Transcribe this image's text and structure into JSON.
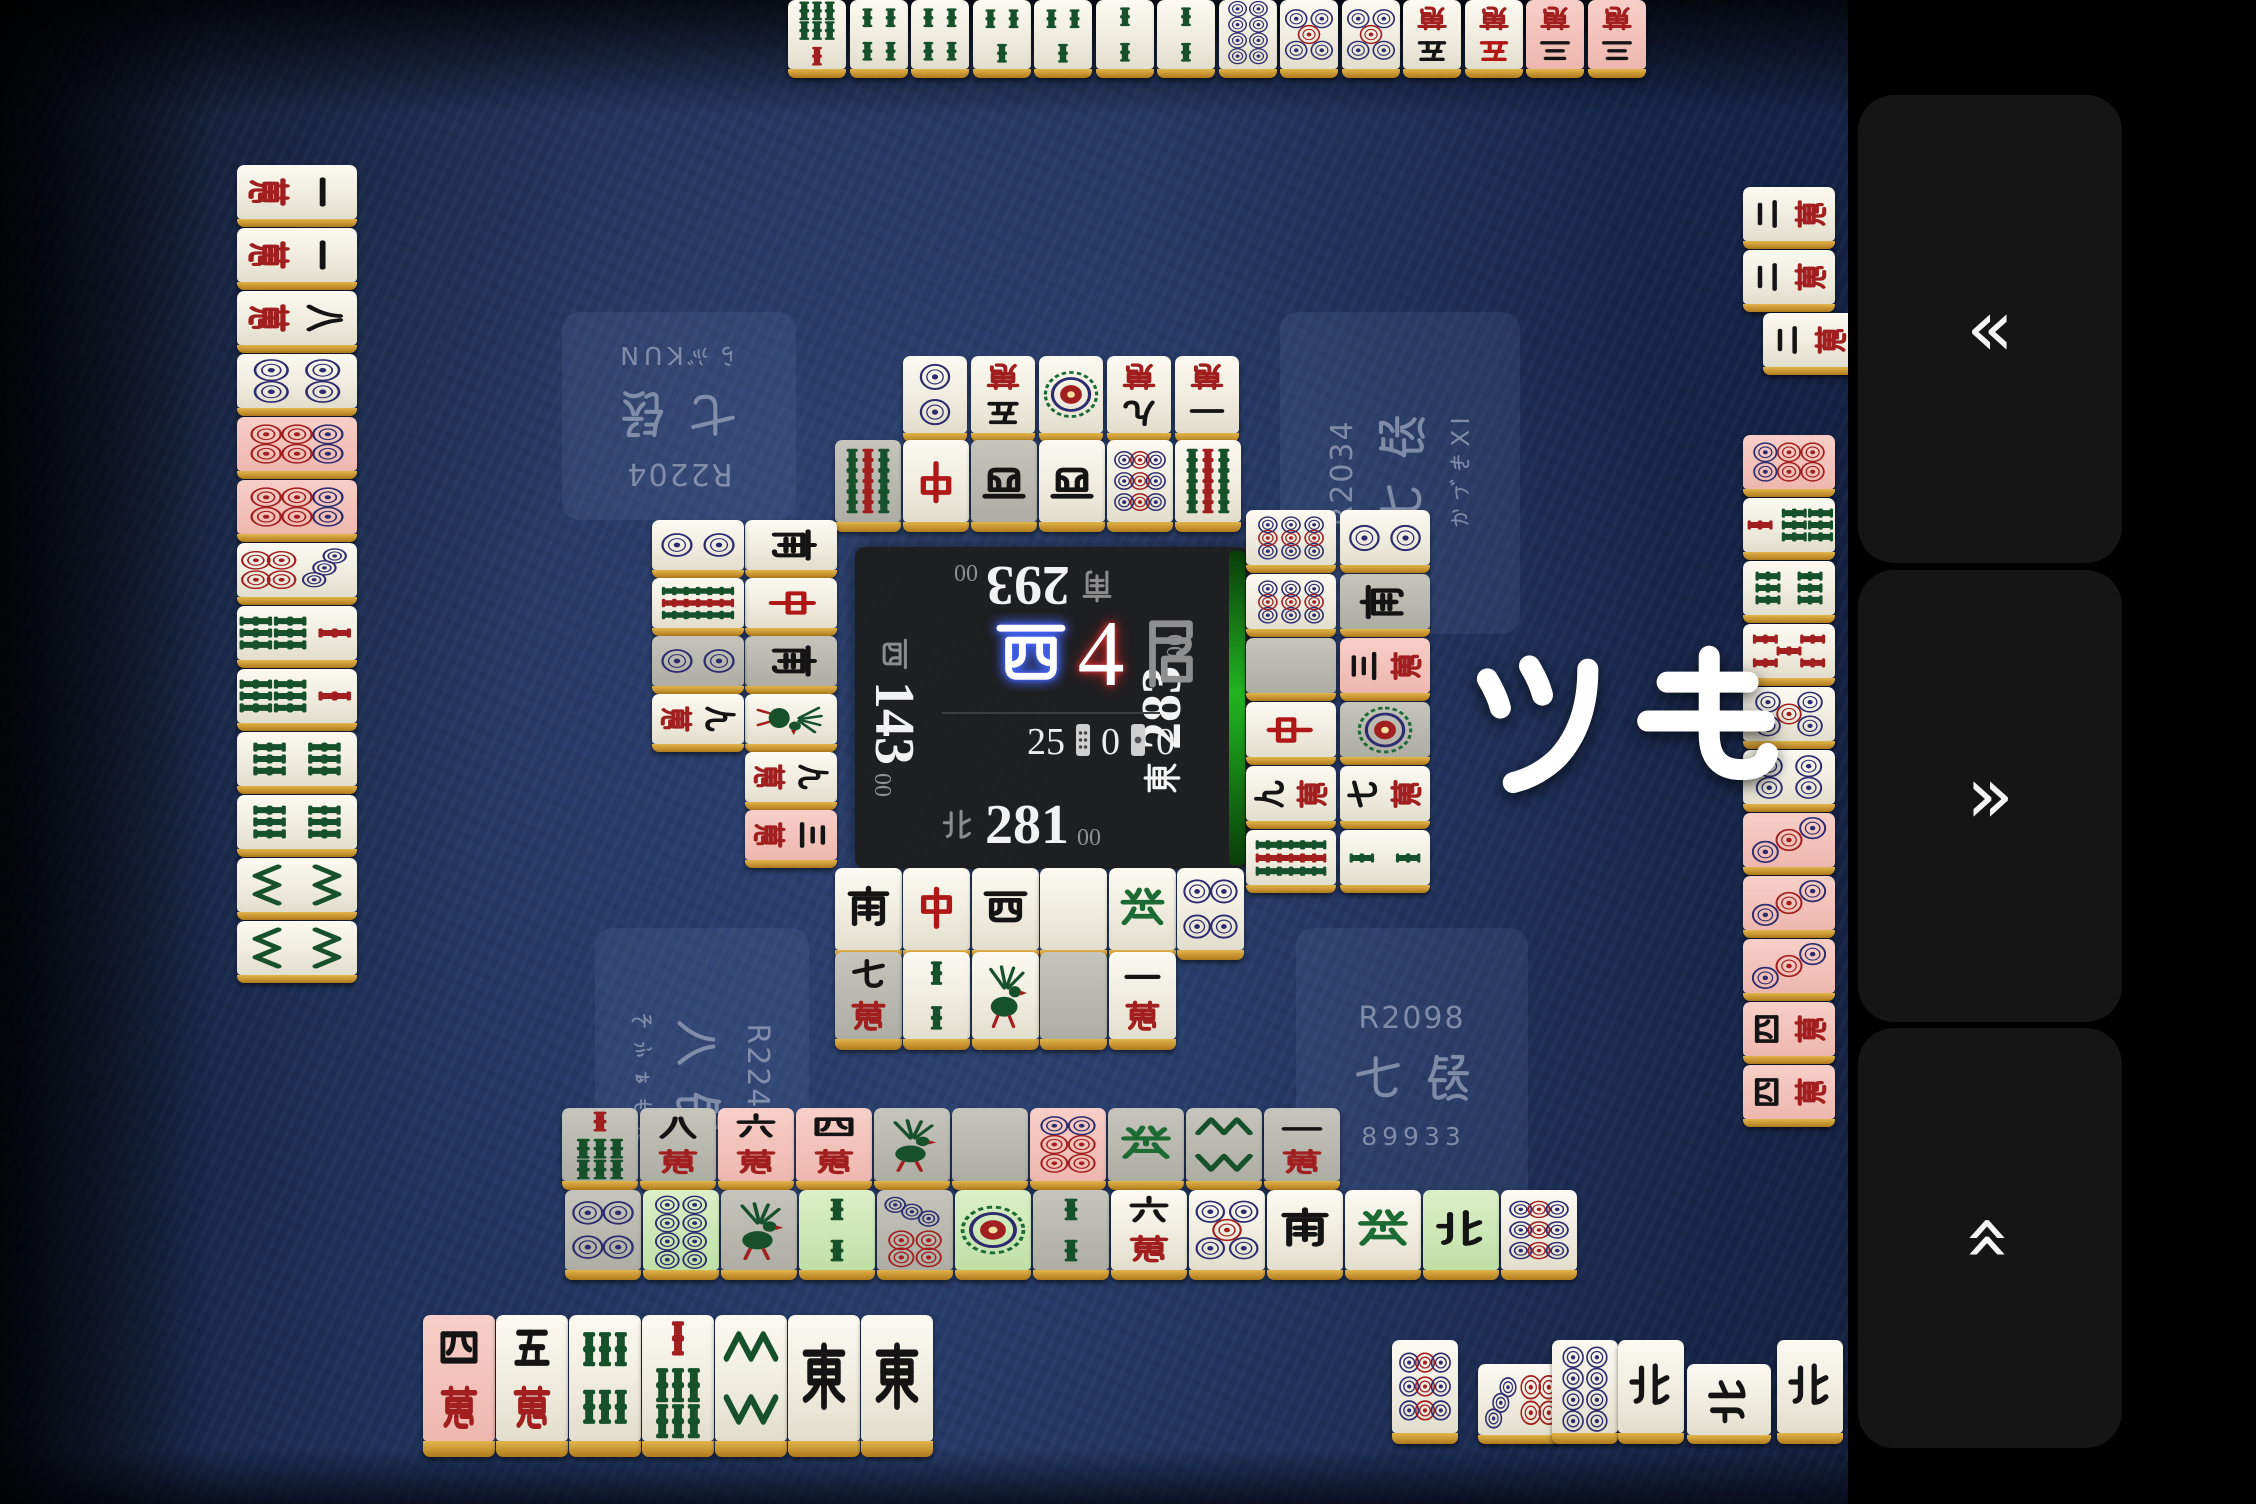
{
  "app": {
    "accent_green": "#1fae1f",
    "table_color": "#1b2a4e"
  },
  "announcement": {
    "text": "ツモ"
  },
  "sidebar": {
    "buttons": [
      {
        "name": "rewind-button",
        "glyph": "«",
        "rotate": 0,
        "x": 10,
        "y": 95,
        "w": 264,
        "h": 468
      },
      {
        "name": "forward-button",
        "glyph": "»",
        "rotate": 0,
        "x": 10,
        "y": 570,
        "w": 264,
        "h": 452
      },
      {
        "name": "collapse-button",
        "glyph": "«",
        "rotate": 90,
        "x": 10,
        "y": 1028,
        "w": 264,
        "h": 420
      }
    ]
  },
  "center": {
    "round": {
      "wind": "西",
      "number": "4",
      "suffix": "局"
    },
    "counters": {
      "tiles_left": "25",
      "honba": "0",
      "riichi_sticks": "0"
    },
    "turn_indicator": "east",
    "seats": {
      "top": {
        "wind": "南",
        "score": "293",
        "sub": "00"
      },
      "left": {
        "wind": "西",
        "score": "143",
        "sub": "00"
      },
      "right": {
        "wind": "東",
        "score": "283",
        "sub": "00"
      },
      "bottom": {
        "wind": "北",
        "score": "281",
        "sub": "00"
      }
    }
  },
  "players": {
    "top_left": {
      "rating": "R2204",
      "rank": "七段",
      "name": "らぶKUN",
      "rotate": 180,
      "x": 562,
      "y": 312,
      "w": 234,
      "h": 208
    },
    "top_right": {
      "rating": "R2034",
      "rank": "七段",
      "name": "かづきXI",
      "rotate": -90,
      "x": 1280,
      "y": 312,
      "w": 240,
      "h": 322
    },
    "bottom_left": {
      "rating": "R2240",
      "rank": "八段",
      "name": "そふぁもん",
      "rotate": 90,
      "x": 595,
      "y": 928,
      "w": 214,
      "h": 298
    },
    "bottom_right": {
      "rating": "R2098",
      "rank": "七段",
      "name": "89933",
      "rotate": 0,
      "x": 1296,
      "y": 928,
      "w": 232,
      "h": 296
    }
  },
  "zones": [
    {
      "name": "top-hand",
      "rot": 180,
      "axis": "x",
      "fixed": 0,
      "w": 58,
      "h": 78,
      "interactable": false,
      "tiles": [
        [
          788,
          "7s"
        ],
        [
          850,
          "4s"
        ],
        [
          911,
          "4s"
        ],
        [
          973,
          "3s"
        ],
        [
          1034,
          "3s"
        ],
        [
          1096,
          "2s"
        ],
        [
          1157,
          "2s"
        ],
        [
          1219,
          "8p"
        ],
        [
          1280,
          "5p"
        ],
        [
          1342,
          "5p"
        ],
        [
          1403,
          "5m"
        ],
        [
          1465,
          "5m",
          "red5"
        ],
        [
          1526,
          "3m",
          "pink"
        ],
        [
          1588,
          "3m",
          "pink"
        ]
      ]
    },
    {
      "name": "top-river-row2",
      "rot": 180,
      "axis": "x",
      "fixed": 356,
      "w": 64,
      "h": 86,
      "interactable": false,
      "tiles": [
        [
          903,
          "2p"
        ],
        [
          971,
          "5m"
        ],
        [
          1039,
          "1p"
        ],
        [
          1107,
          "9m"
        ],
        [
          1175,
          "1m"
        ]
      ]
    },
    {
      "name": "top-river-row1",
      "rot": 180,
      "axis": "x",
      "fixed": 440,
      "w": 66,
      "h": 92,
      "interactable": false,
      "tiles": [
        [
          835,
          "9s",
          "gray"
        ],
        [
          903,
          "C"
        ],
        [
          971,
          "W",
          "gray"
        ],
        [
          1039,
          "W"
        ],
        [
          1107,
          "9p"
        ],
        [
          1175,
          "9s"
        ]
      ]
    },
    {
      "name": "left-hand",
      "rot": 90,
      "axis": "y",
      "fixed": 237,
      "w": 120,
      "h": 62,
      "interactable": false,
      "tiles": [
        [
          165,
          "1m"
        ],
        [
          228,
          "1m"
        ],
        [
          291,
          "8m"
        ],
        [
          354,
          "4p"
        ],
        [
          417,
          "6p",
          "pink"
        ],
        [
          480,
          "6p",
          "pink"
        ],
        [
          543,
          "7p"
        ],
        [
          606,
          "7s"
        ],
        [
          669,
          "7s"
        ],
        [
          732,
          "6s"
        ],
        [
          795,
          "6s"
        ],
        [
          858,
          "8s"
        ],
        [
          921,
          "8s"
        ]
      ]
    },
    {
      "name": "left-river-col1",
      "rot": 90,
      "axis": "y",
      "fixed": 745,
      "w": 92,
      "h": 58,
      "interactable": false,
      "tiles": [
        [
          520,
          "S"
        ],
        [
          578,
          "C"
        ],
        [
          636,
          "S",
          "gray"
        ],
        [
          694,
          "1s"
        ],
        [
          752,
          "9m"
        ],
        [
          810,
          "3m",
          "pink"
        ]
      ]
    },
    {
      "name": "left-river-col2",
      "rot": 90,
      "axis": "y",
      "fixed": 652,
      "w": 92,
      "h": 58,
      "interactable": false,
      "tiles": [
        [
          520,
          "2p"
        ],
        [
          578,
          "9s"
        ],
        [
          636,
          "2p",
          "gray"
        ],
        [
          694,
          "9m"
        ]
      ]
    },
    {
      "name": "right-river-col1",
      "rot": -90,
      "axis": "y",
      "fixed": 1246,
      "w": 90,
      "h": 63,
      "interactable": false,
      "tiles": [
        [
          510,
          "9p"
        ],
        [
          574,
          "9p"
        ],
        [
          638,
          "B",
          "gray"
        ],
        [
          702,
          "C"
        ],
        [
          766,
          "9m"
        ],
        [
          830,
          "9s"
        ]
      ]
    },
    {
      "name": "right-river-col2",
      "rot": -90,
      "axis": "y",
      "fixed": 1340,
      "w": 90,
      "h": 63,
      "interactable": false,
      "tiles": [
        [
          510,
          "2p"
        ],
        [
          574,
          "S",
          "gray"
        ],
        [
          638,
          "3m",
          "pink"
        ],
        [
          702,
          "1p",
          "gray"
        ],
        [
          766,
          "7m"
        ],
        [
          830,
          "2s"
        ]
      ]
    },
    {
      "name": "right-hand-revealed",
      "rot": -90,
      "axis": "y",
      "fixed": 1743,
      "w": 92,
      "h": 62,
      "interactable": false,
      "tiles": [
        [
          187,
          "2m"
        ],
        [
          250,
          "2m"
        ],
        [
          313,
          "2m",
          null,
          20
        ],
        [
          435,
          "6p",
          "pink"
        ],
        [
          498,
          "7s"
        ],
        [
          561,
          "6s"
        ],
        [
          624,
          "5s",
          "red5"
        ],
        [
          687,
          "5p"
        ],
        [
          750,
          "4p"
        ],
        [
          813,
          "3p",
          "pink"
        ],
        [
          876,
          "3p",
          "pink"
        ],
        [
          939,
          "3p",
          "pink"
        ],
        [
          1002,
          "4m",
          "pink"
        ],
        [
          1065,
          "4m",
          "pink"
        ]
      ]
    },
    {
      "name": "bottom-river-row1",
      "rot": 0,
      "axis": "x",
      "fixed": 868,
      "w": 67,
      "h": 92,
      "interactable": false,
      "tiles": [
        [
          835,
          "S"
        ],
        [
          903,
          "C"
        ],
        [
          972,
          "W"
        ],
        [
          1040,
          "B"
        ],
        [
          1109,
          "H"
        ],
        [
          1177,
          "4p"
        ]
      ]
    },
    {
      "name": "bottom-river-row2",
      "rot": 0,
      "axis": "x",
      "fixed": 952,
      "w": 67,
      "h": 98,
      "interactable": false,
      "tiles": [
        [
          835,
          "7m",
          "gray"
        ],
        [
          903,
          "2s"
        ],
        [
          972,
          "1s"
        ],
        [
          1040,
          "B",
          "gray"
        ],
        [
          1109,
          "1m"
        ]
      ]
    },
    {
      "name": "revealed-wall-row1",
      "rot": 0,
      "axis": "x",
      "fixed": 1108,
      "w": 76,
      "h": 82,
      "interactable": false,
      "tiles": [
        [
          562,
          "7s",
          "gray"
        ],
        [
          640,
          "8m",
          "gray"
        ],
        [
          718,
          "6m",
          "pink"
        ],
        [
          796,
          "4m",
          "pink"
        ],
        [
          874,
          "1s",
          "gray"
        ],
        [
          952,
          "B",
          "gray"
        ],
        [
          1030,
          "6p",
          "pink"
        ],
        [
          1108,
          "H",
          "gray"
        ],
        [
          1186,
          "8s",
          "gray"
        ],
        [
          1264,
          "1m",
          "gray"
        ]
      ]
    },
    {
      "name": "revealed-wall-row2",
      "rot": 0,
      "axis": "x",
      "fixed": 1190,
      "w": 76,
      "h": 90,
      "interactable": false,
      "tiles": [
        [
          565,
          "4p",
          "gray"
        ],
        [
          643,
          "8p",
          "green"
        ],
        [
          721,
          "1s",
          "gray"
        ],
        [
          799,
          "2s",
          "green"
        ],
        [
          877,
          "7p",
          "gray"
        ],
        [
          955,
          "1p",
          "green"
        ],
        [
          1033,
          "2s",
          "gray"
        ],
        [
          1111,
          "6m"
        ],
        [
          1189,
          "5p"
        ],
        [
          1267,
          "S"
        ],
        [
          1345,
          "H"
        ],
        [
          1423,
          "N",
          "green"
        ],
        [
          1501,
          "9p"
        ]
      ]
    },
    {
      "name": "bottom-hand",
      "rot": 0,
      "axis": "x",
      "fixed": 1315,
      "w": 72,
      "h": 142,
      "interactable": true,
      "tiles": [
        [
          423,
          "4m",
          "pink"
        ],
        [
          496,
          "5m"
        ],
        [
          569,
          "6s"
        ],
        [
          642,
          "7s"
        ],
        [
          715,
          "8s"
        ],
        [
          788,
          "E"
        ],
        [
          861,
          "E"
        ]
      ]
    },
    {
      "name": "bottom-melds",
      "rot": 0,
      "axis": "x",
      "fixed": 1340,
      "w": 66,
      "h": 104,
      "interactable": false,
      "tiles": [
        {
          "x": 1392,
          "face": "9p"
        },
        {
          "x": 1478,
          "face": "7p",
          "turned": true
        },
        {
          "x": 1552,
          "face": "8p"
        },
        {
          "x": 1618,
          "face": "N"
        },
        {
          "x": 1687,
          "face": "N",
          "turned": true
        },
        {
          "x": 1777,
          "face": "N"
        }
      ]
    }
  ]
}
